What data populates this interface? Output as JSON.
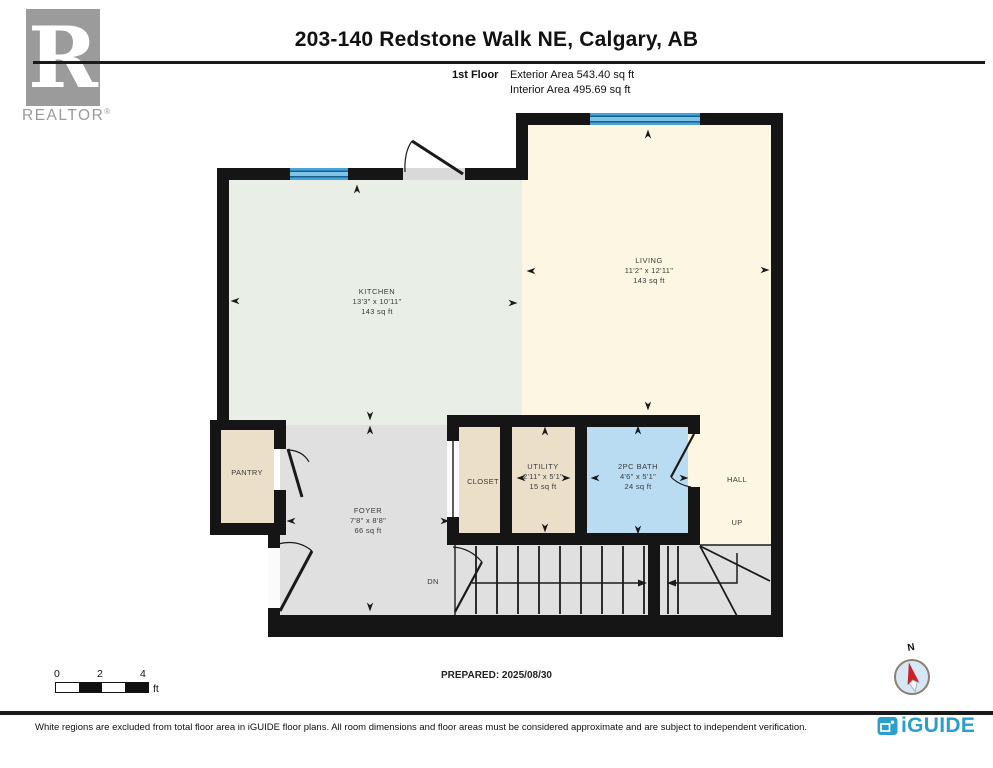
{
  "header": {
    "realtor": {
      "letter": "R",
      "label": "REALTOR",
      "registered": "®"
    },
    "title": "203-140 Redstone Walk NE, Calgary, AB",
    "floor_label": "1st Floor",
    "exterior_area": "Exterior Area 543.40 sq ft",
    "interior_area": "Interior Area 495.69 sq ft"
  },
  "rooms": {
    "kitchen": {
      "name": "KITCHEN",
      "dimensions": "13'3\" x 10'11\"",
      "area": "143 sq ft"
    },
    "living": {
      "name": "LIVING",
      "dimensions": "11'2\" x 12'11\"",
      "area": "143 sq ft"
    },
    "pantry": {
      "name": "PANTRY"
    },
    "foyer": {
      "name": "FOYER",
      "dimensions": "7'8\" x 8'8\"",
      "area": "66 sq ft"
    },
    "closet": {
      "name": "CLOSET"
    },
    "utility": {
      "name": "UTILITY",
      "dimensions": "2'11\" x 5'1\"",
      "area": "15 sq ft"
    },
    "bath": {
      "name": "2PC BATH",
      "dimensions": "4'6\" x 5'1\"",
      "area": "24 sq ft"
    },
    "hall": {
      "name": "HALL"
    },
    "up_label": "UP",
    "dn_label": "DN"
  },
  "scale_bar": {
    "tick0": "0",
    "tick2": "2",
    "tick4": "4",
    "unit": "ft"
  },
  "prepared": {
    "text": "PREPARED: 2025/08/30"
  },
  "compass": {
    "north_label": "N"
  },
  "footer": {
    "disclaimer": "White regions are excluded from total floor area in iGUIDE floor plans. All room dimensions and floor areas must be considered approximate and are subject to independent verification.",
    "brand": "iGUIDE"
  },
  "colors": {
    "wall": "#151515",
    "kitchen_fill": "#e9efe7",
    "living_fill": "#fdf6e2",
    "foyer_fill": "#e0e0e0",
    "storage_fill": "#ecdfc9",
    "bath_fill": "#b9dcf2",
    "window_blue": "#4aa3d6",
    "brand_blue": "#2a9fcf",
    "compass_red": "#cc2127",
    "realtor_gray": "#9b9b9b"
  }
}
